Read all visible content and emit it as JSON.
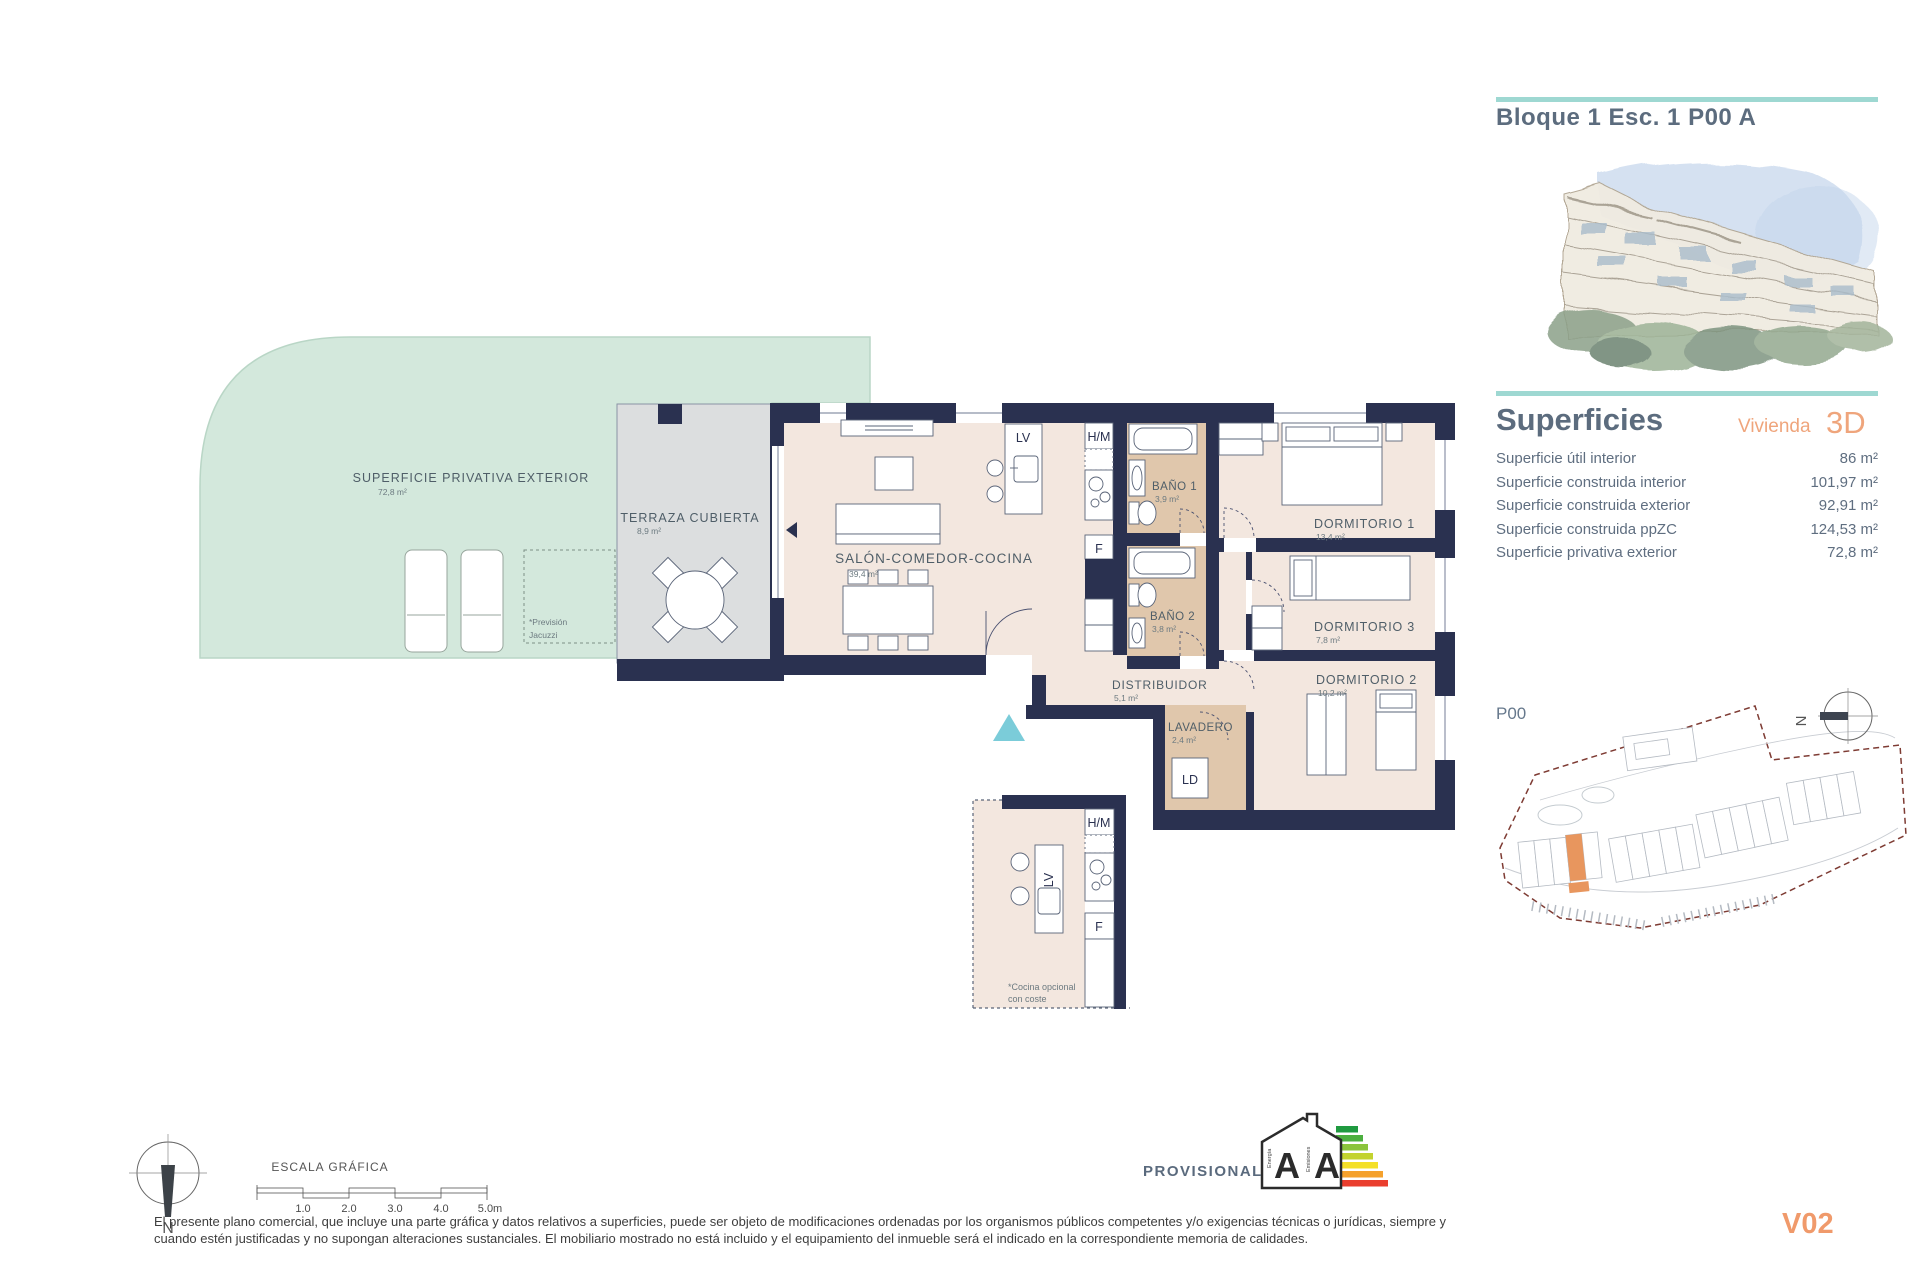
{
  "header": {
    "title": "Bloque 1 Esc. 1 P00 A"
  },
  "superficies": {
    "title": "Superficies",
    "subtitle": "Vivienda",
    "badge": "3D",
    "rows": [
      {
        "label": "Superficie útil interior",
        "value": "86 m²"
      },
      {
        "label": "Superficie construida interior",
        "value": "101,97 m²"
      },
      {
        "label": "Superficie construida exterior",
        "value": "92,91 m²"
      },
      {
        "label": "Superficie construida ppZC",
        "value": "124,53 m²"
      },
      {
        "label": "Superficie privativa exterior",
        "value": "72,8 m²"
      }
    ]
  },
  "rooms": {
    "exterior": {
      "label": "SUPERFICIE PRIVATIVA EXTERIOR",
      "area": "72,8 m²"
    },
    "terraza": {
      "label": "TERRAZA CUBIERTA",
      "area": "8,9 m²"
    },
    "salon": {
      "label": "SALÓN-COMEDOR-COCINA",
      "area": "39,4 m²"
    },
    "bano1": {
      "label": "BAÑO 1",
      "area": "3,9 m²"
    },
    "bano2": {
      "label": "BAÑO 2",
      "area": "3,8 m²"
    },
    "dorm1": {
      "label": "DORMITORIO 1",
      "area": "13,4 m²"
    },
    "dorm3": {
      "label": "DORMITORIO 3",
      "area": "7,8 m²"
    },
    "dorm2": {
      "label": "DORMITORIO 2",
      "area": "10,2 m²"
    },
    "distribuidor": {
      "label": "DISTRIBUIDOR",
      "area": "5,1 m²"
    },
    "lavadero": {
      "label": "LAVADERO",
      "area": "2,4 m²"
    }
  },
  "appliances": {
    "lv": "LV",
    "hm": "H/M",
    "f": "F",
    "ld": "LD"
  },
  "notes": {
    "jacuzzi_1": "*Previsión",
    "jacuzzi_2": "Jacuzzi",
    "cocina_1": "*Cocina opcional",
    "cocina_2": "con coste"
  },
  "siteplan": {
    "label": "P00",
    "north": "N"
  },
  "compass": {
    "label": "N"
  },
  "scalebar": {
    "title": "ESCALA GRÁFICA",
    "ticks": [
      "1.0",
      "2.0",
      "3.0",
      "4.0",
      "5.0m"
    ]
  },
  "energy": {
    "label": "PROVISIONAL",
    "letter_energy": "A",
    "letter_emissions": "A",
    "axis_energy": "Energía",
    "axis_emissions": "Emisiones"
  },
  "footer": {
    "line1": "El presente plano comercial, que incluye una parte gráfica y datos relativos a superficies, puede ser objeto de modificaciones ordenadas por los organismos públicos competentes y/o exigencias técnicas o jurídicas, siempre y",
    "line2": "cuando estén justificadas y no supongan alteraciones sustanciales. El mobiliario mostrado no está incluido y el equipamiento del inmueble será el indicado en la correspondiente memoria de calidades.",
    "version": "V02"
  },
  "colors": {
    "wall": "#2a3150",
    "floor": "#f3e7df",
    "wet_floor": "#e0c7ac",
    "terrace_gray": "#dcdedf",
    "garden_green": "#d3e8dc",
    "accent_teal": "#9ed8d2",
    "accent_orange": "#efa57c",
    "entry_arrow": "#7bccd9",
    "boundary_red": "#7e3b33"
  }
}
